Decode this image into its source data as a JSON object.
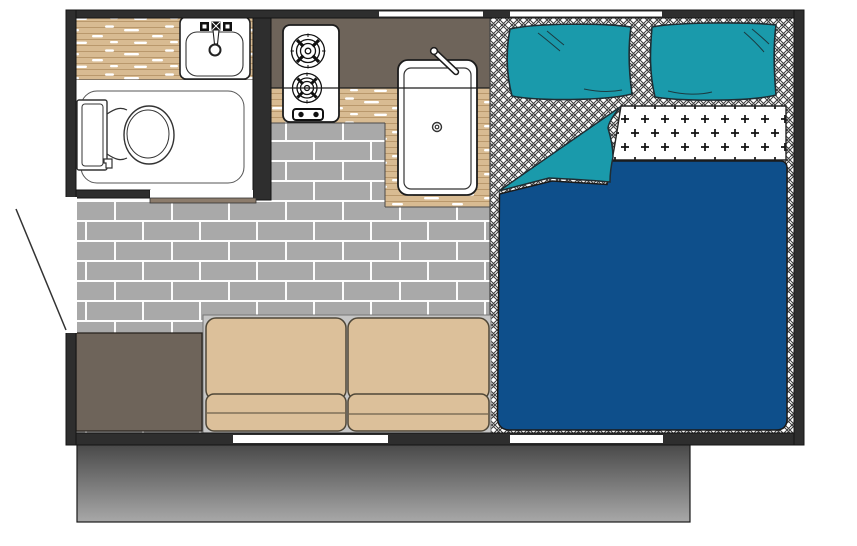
{
  "page": {
    "kind": "camper-floor-plan",
    "background": "#ffffff",
    "has_visible_text": false
  },
  "colors": {
    "wall": "#2e2e2e",
    "wall_edge": "#141414",
    "teal": "#1a9aab",
    "duvet_blue": "#0e4f8b",
    "sofa_tan": "#dcc09a",
    "sofa_edge": "#4f4738",
    "sofa_base_gray": "#c6c6c6",
    "counter_taupe": "#6e645a",
    "storage_taupe": "#6e645a",
    "threshold_taupe": "#8c7c6c",
    "wood_base": "#d8bb92",
    "wood_grain": "#b9986c",
    "wood_streak": "#ffffff",
    "brick_gray": "#a9a9a9",
    "mortar_white": "#fdfdfd",
    "hatch_line": "#3c3c3c",
    "plus_black": "#111111",
    "platform_top": "#474747",
    "platform_bottom": "#a8a8a8",
    "fixture_line": "#222222",
    "crease_dark": "#1b3a40",
    "white": "#ffffff"
  },
  "structure": {
    "wall_thickness_px": 10,
    "top_windows": 2,
    "bottom_openings": 2,
    "side_door": 1,
    "rooms": [
      "bathroom",
      "kitchen",
      "living-area",
      "bed-area"
    ],
    "furniture": [
      "vanity-counter",
      "bathroom-sink",
      "toilet",
      "two-burner-stove",
      "kitchen-sink",
      "kitchen-counter",
      "sofa-two-seat",
      "storage-bench",
      "double-bed",
      "pillow-left",
      "pillow-right",
      "folded-sheet",
      "duvet"
    ]
  }
}
